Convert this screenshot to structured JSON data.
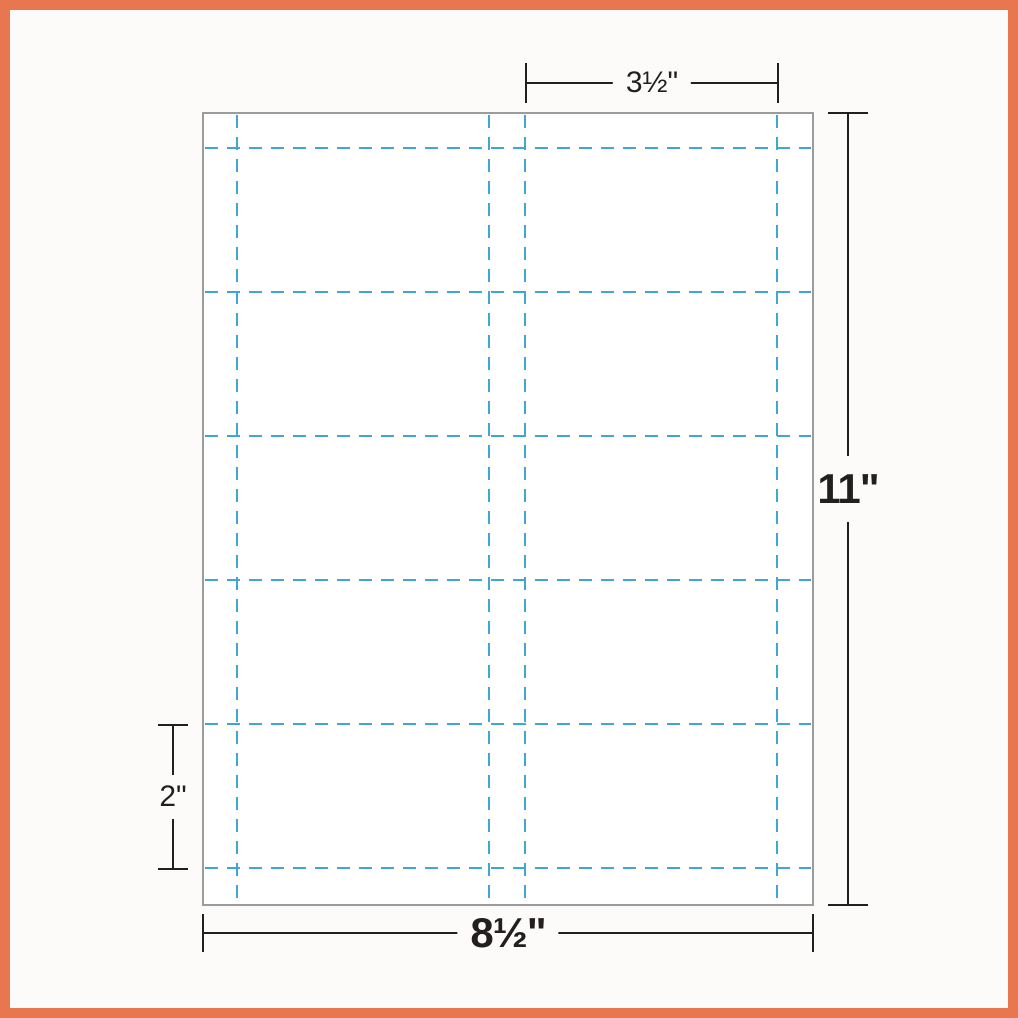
{
  "diagram": {
    "description": "Blank business-card sheet template with cut lines and dimension callouts",
    "sheet": {
      "rows": 5,
      "columns": 2,
      "fill": "#FFFFFF",
      "border_color": "#9C9C9C"
    },
    "colors": {
      "frame": "#E8764E",
      "background": "#FCFBF9",
      "cut_line": "#3FA7D3",
      "dimension_line": "#231F20"
    },
    "dimensions": {
      "card_width_label": "3½\"",
      "sheet_height_label": "11\"",
      "card_height_label": "2\"",
      "sheet_width_label": "8½\""
    }
  }
}
